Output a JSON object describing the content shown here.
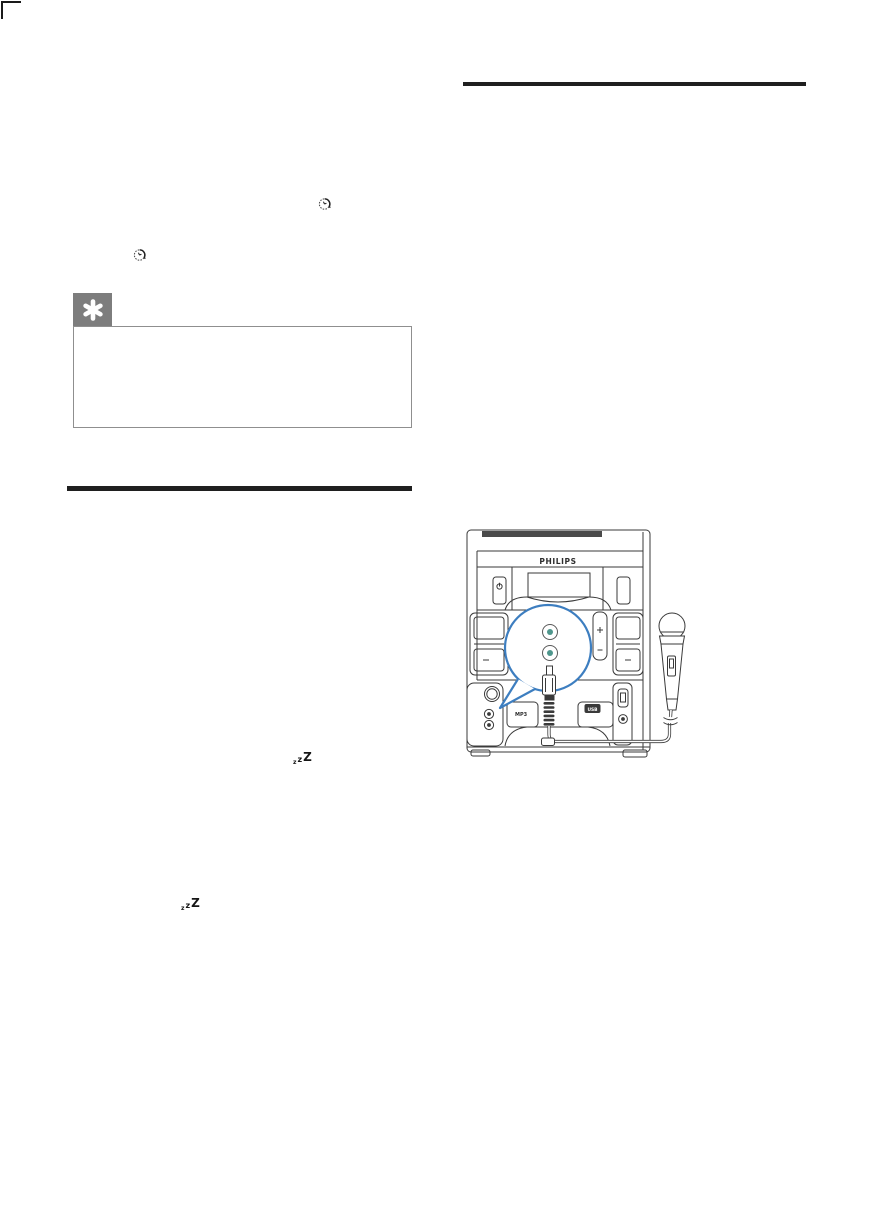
{
  "page": {
    "background": "#ffffff"
  },
  "colors": {
    "divider": "#1f1f1f",
    "tip_tab_gray": "#7d7d7d",
    "line_art": "#3a3a3a",
    "callout_blue": "#3d7ec0",
    "jack_teal": "#4e968c"
  },
  "icons": {
    "timer": "timer-clock",
    "tip": "asterisk",
    "sleep": "zzZ"
  },
  "sleep_icon": {
    "z_small": "z",
    "z_mid": "z",
    "z_large": "Z"
  },
  "device": {
    "brand": "PHILIPS",
    "mp3_label": "MP3",
    "usb_label": "USB"
  }
}
